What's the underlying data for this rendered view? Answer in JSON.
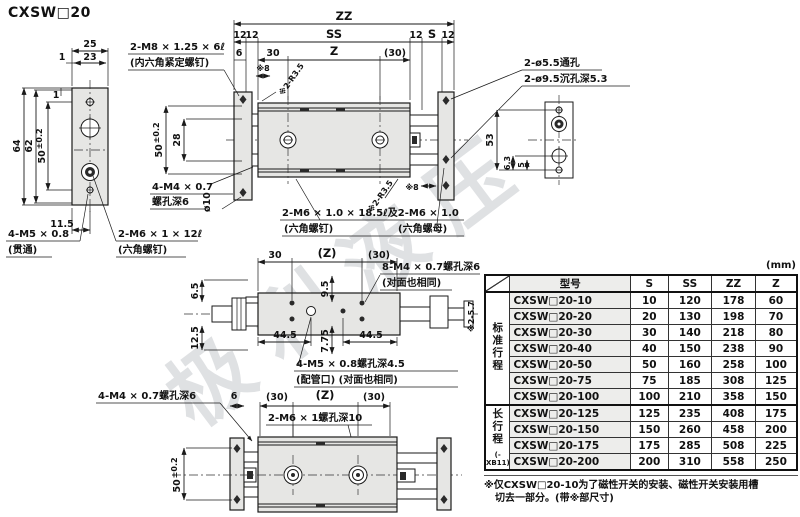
{
  "labels": {
    "title": "CXSW□20",
    "watermark": "极利液压",
    "dim_zz": "ZZ",
    "dim_ss": "SS",
    "dim_s": "S",
    "dim_z": "Z",
    "dim_zp": "(Z)",
    "n12": "12",
    "n6": "6",
    "n30": "30",
    "n30p": "(30)",
    "n25": "25",
    "n23": "23",
    "n1": "1",
    "n64": "64",
    "n62": "62",
    "n50": "50",
    "tol": "±0.2",
    "n11_5": "11.5",
    "n28": "28",
    "n53": "53",
    "n6_3": "6.3",
    "n5": "5",
    "n6_5": "6.5",
    "n12_5": "12.5",
    "n9_5": "9.5",
    "n7_75": "7.75",
    "n44_5": "44.5",
    "star8": "※8",
    "star_r": "※2-R3.5",
    "star57": "※2-5.7",
    "phi10": "ø10",
    "co_m8_1": "2-M8 × 1.25 × 6ℓ",
    "co_m8_2": "(内六角紧定螺钉)",
    "co_thru": "2-ø5.5通孔",
    "co_cbore": "2-ø9.5沉孔深5.3",
    "co_m4_1": "4-M4 × 0.7",
    "co_m4_2": "螺孔深6",
    "co_m4_full": "4-M4 × 0.7螺孔深6",
    "co_m5_1": "4-M5 × 0.8",
    "co_m5_2": "(贯通)",
    "co_m6a_1": "2-M6 × 1 × 12ℓ",
    "co_m6a_2": "(六角螺钉)",
    "co_m6b_1": "2-M6 × 1.0 × 18.5ℓ及2-M6 × 1.0",
    "co_m6b_2": "(六角螺钉)",
    "co_m6b_3": "(六角螺母)",
    "co_8m4_1": "8-M4 × 0.7螺孔深6",
    "co_8m4_2": "(对面也相同)",
    "co_4m5_1": "4-M5 × 0.8螺孔深4.5",
    "co_4m5_2": "(配管口) (对面也相同)",
    "co_2m6_1": "2-M6 × 1螺孔深10"
  },
  "table": {
    "unit": "(mm)",
    "headers": {
      "model": "型号",
      "s": "S",
      "ss": "SS",
      "zz": "ZZ",
      "z": "Z"
    },
    "group1": {
      "label": "标准行程",
      "rows": [
        {
          "m": "CXSW□20-10",
          "s": "10",
          "ss": "120",
          "zz": "178",
          "z": "60"
        },
        {
          "m": "CXSW□20-20",
          "s": "20",
          "ss": "130",
          "zz": "198",
          "z": "70"
        },
        {
          "m": "CXSW□20-30",
          "s": "30",
          "ss": "140",
          "zz": "218",
          "z": "80"
        },
        {
          "m": "CXSW□20-40",
          "s": "40",
          "ss": "150",
          "zz": "238",
          "z": "90"
        },
        {
          "m": "CXSW□20-50",
          "s": "50",
          "ss": "160",
          "zz": "258",
          "z": "100"
        },
        {
          "m": "CXSW□20-75",
          "s": "75",
          "ss": "185",
          "zz": "308",
          "z": "125"
        },
        {
          "m": "CXSW□20-100",
          "s": "100",
          "ss": "210",
          "zz": "358",
          "z": "150"
        }
      ]
    },
    "group2": {
      "label": "长行程",
      "sub": "(-XB11)",
      "rows": [
        {
          "m": "CXSW□20-125",
          "s": "125",
          "ss": "235",
          "zz": "408",
          "z": "175"
        },
        {
          "m": "CXSW□20-150",
          "s": "150",
          "ss": "260",
          "zz": "458",
          "z": "200"
        },
        {
          "m": "CXSW□20-175",
          "s": "175",
          "ss": "285",
          "zz": "508",
          "z": "225"
        },
        {
          "m": "CXSW□20-200",
          "s": "200",
          "ss": "310",
          "zz": "558",
          "z": "250"
        }
      ]
    },
    "notes": {
      "line1": "※仅CXSW□20-10为了磁性开关的安装、磁性开关安装用槽",
      "line2": "切去一部分。(带※部尺寸)"
    }
  }
}
